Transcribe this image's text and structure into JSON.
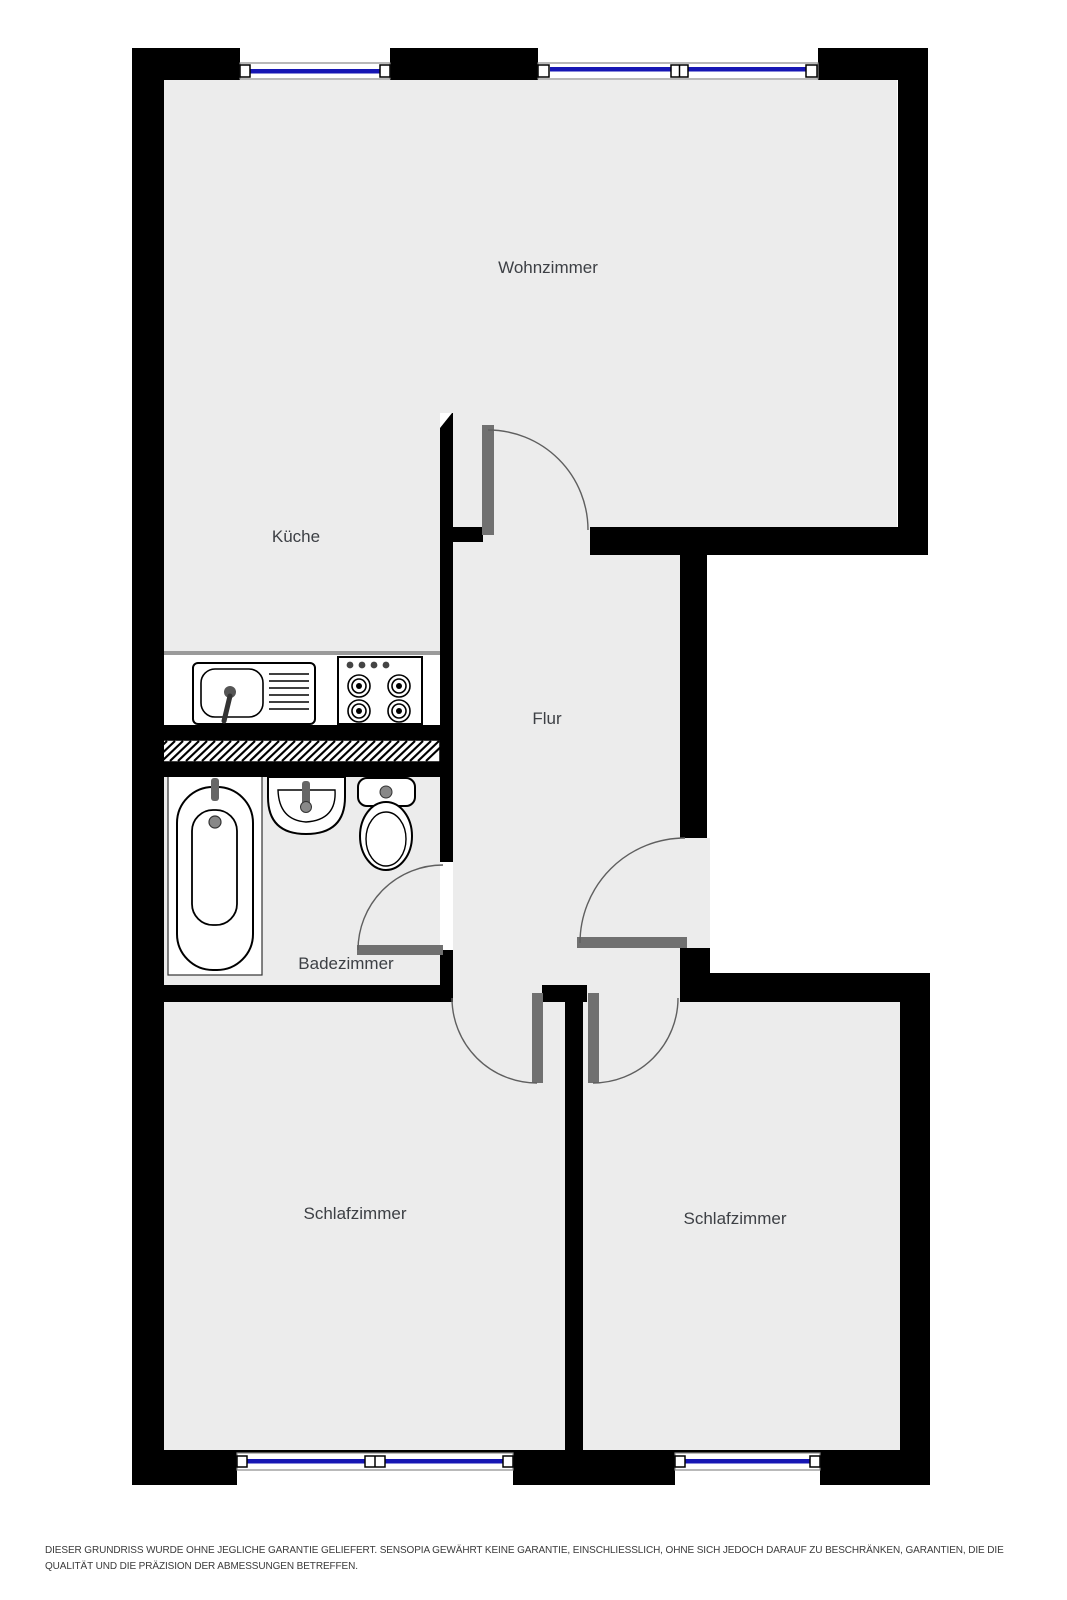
{
  "floorplan": {
    "rooms": {
      "wohnzimmer": "Wohnzimmer",
      "kueche": "Küche",
      "flur": "Flur",
      "badezimmer": "Badezimmer",
      "schlafzimmer_links": "Schlafzimmer",
      "schlafzimmer_rechts": "Schlafzimmer"
    },
    "colors": {
      "wall": "#000000",
      "floor": "#ececec",
      "window_blue": "#1616b4",
      "door_gray": "#707070",
      "arc_gray": "#5f5f5f",
      "label_text": "#3d4045"
    },
    "fixtures": [
      "kitchen-sink",
      "kitchen-stove",
      "bathtub",
      "bathroom-sink",
      "toilet"
    ]
  },
  "disclaimer": {
    "line1": "DIESER GRUNDRISS WURDE OHNE JEGLICHE GARANTIE GELIEFERT. SENSOPIA GEWÄHRT KEINE GARANTIE, EINSCHLIESSLICH, OHNE SICH JEDOCH DARAUF ZU BESCHRÄNKEN, GARANTIEN, DIE DIE",
    "line2": "QUALITÄT UND DIE PRÄZISION DER ABMESSUNGEN BETREFFEN."
  }
}
